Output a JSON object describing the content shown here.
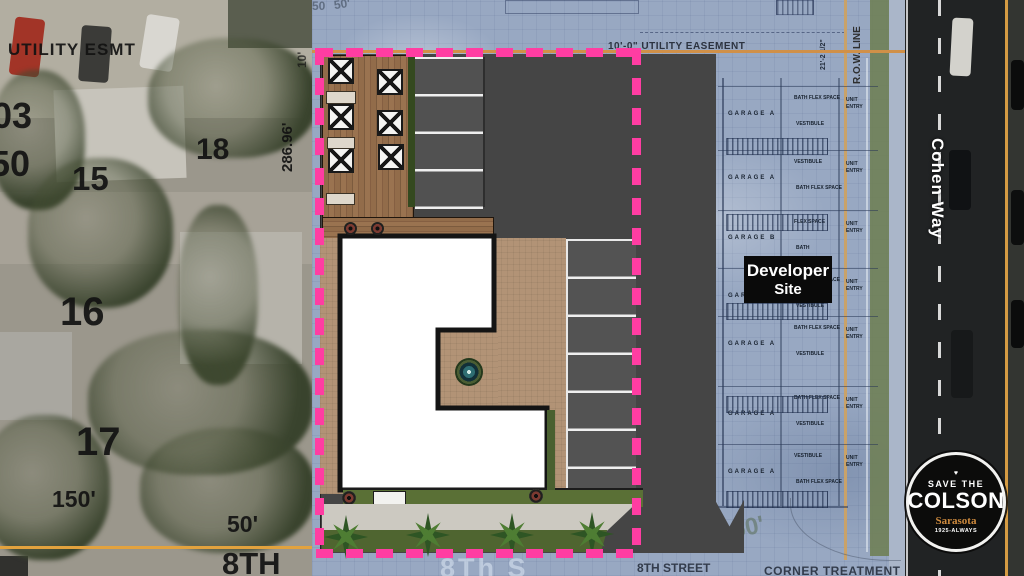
{
  "aerial": {
    "utility_esmt": "UTILITY ESMT",
    "lot_03": "03",
    "lot_50": "50",
    "lot_15": "15",
    "lot_18": "18",
    "lot_16": "16",
    "lot_17": "17",
    "dim_150": "150'",
    "dim_50": "50'",
    "dim_286": "286.96'",
    "dim_10": "10'",
    "street_8th_big": "8TH"
  },
  "site_plan": {
    "easement_top": "10'-0\" UTILITY EASEMENT",
    "row_line": "R.O.W. LINE",
    "dim_21": "21'-2 1/2\"",
    "faded_50_a": "50",
    "faded_50_b": "50'",
    "faded_50_bottom": "50'",
    "watermark_street": "8Th S",
    "street_8th": "8TH STREET",
    "corner_treatment": "CORNER TREATMENT",
    "developer_site": {
      "line1": "Developer",
      "line2": "Site"
    },
    "garage_rows": [
      {
        "garage": "GARAGE  A",
        "top": "BATH  FLEX SPACE",
        "bottom": "VESTIBULE",
        "entry": "UNIT ENTRY"
      },
      {
        "garage": "GARAGE  A",
        "top": "VESTIBULE",
        "bottom": "BATH  FLEX SPACE",
        "entry": "UNIT ENTRY"
      },
      {
        "garage": "GARAGE  B",
        "top": "FLEX SPACE",
        "bottom": "BATH",
        "entry": "UNIT ENTRY"
      },
      {
        "garage": "GARAGE  A",
        "top": "BATH  FLEX SPACE",
        "bottom": "VESTIBULE",
        "entry": "UNIT ENTRY"
      },
      {
        "garage": "GARAGE  A",
        "top": "BATH  FLEX SPACE",
        "bottom": "VESTIBULE",
        "entry": "UNIT ENTRY"
      },
      {
        "garage": "GARAGE  A",
        "top": "BATH  FLEX SPACE",
        "bottom": "VESTIBULE",
        "entry": "UNIT ENTRY"
      },
      {
        "garage": "GARAGE  A",
        "top": "VESTIBULE",
        "bottom": "BATH  FLEX SPACE",
        "entry": "UNIT ENTRY"
      }
    ]
  },
  "road": {
    "name": "Cohen Way"
  },
  "badge": {
    "heart": "♥",
    "top": "SAVE THE",
    "name": "COLSON",
    "city": "Sarasota",
    "tagline": "1925-ALWAYS"
  },
  "colors": {
    "boundary_pink": "#ff3da2",
    "easement_orange": "#d09048",
    "row_line_tan": "#c9a269",
    "pavement_gray": "#454545",
    "blueprint_blue": "#98a8c2",
    "badge_accent": "#cf8b3e"
  }
}
